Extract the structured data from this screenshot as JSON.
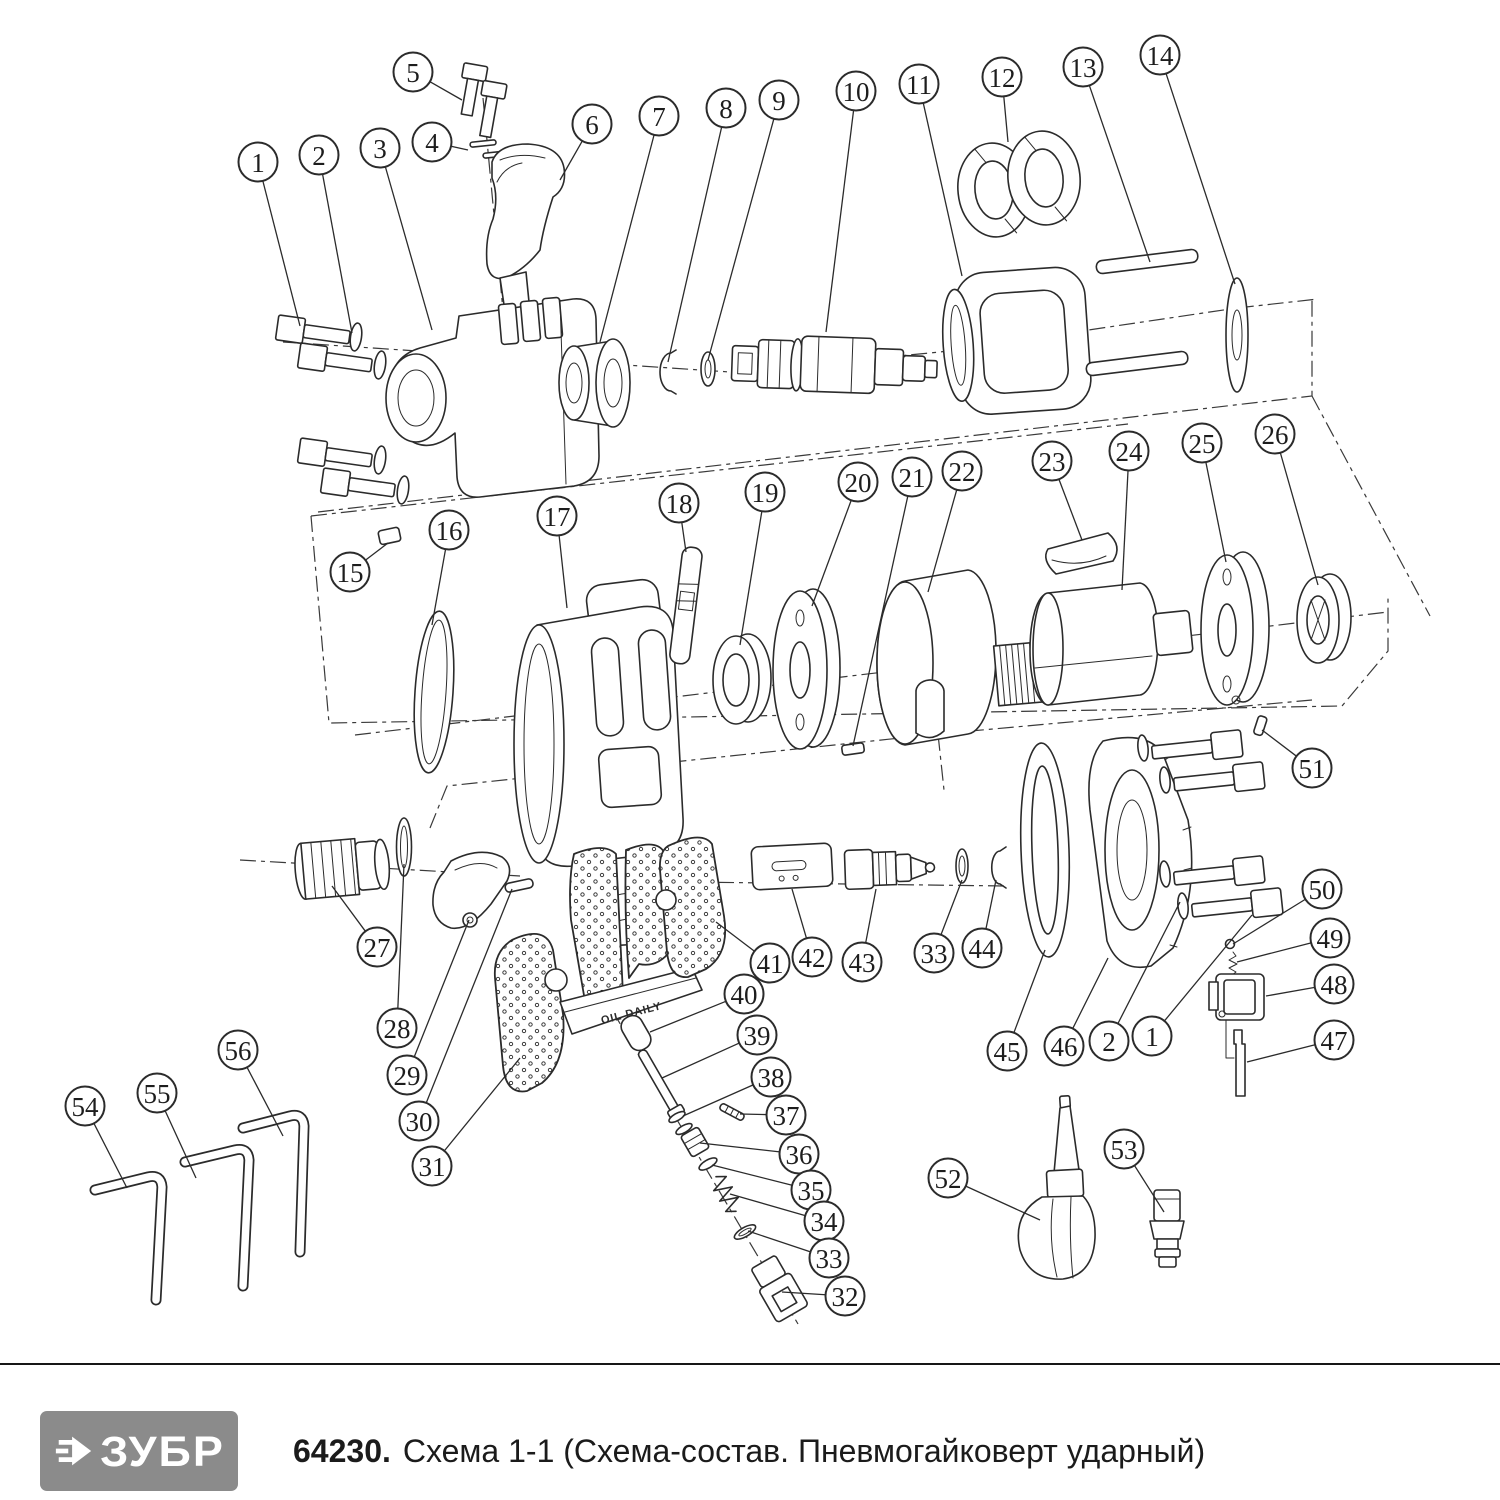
{
  "footer": {
    "brand": "ЗУБР",
    "brand_bg": "#8b8b8b",
    "code": "64230.",
    "title": "Схема 1-1 (Схема-состав. Пневмогайковерт ударный)"
  },
  "diagram": {
    "description": "Exploded parts diagram of a pneumatic impact wrench with numbered callouts",
    "embossed_text": "OIL DAILY",
    "line_color": "#2b2b2b",
    "callouts": [
      {
        "n": "1",
        "x": 258,
        "y": 162,
        "tx": 300,
        "ty": 326
      },
      {
        "n": "2",
        "x": 319,
        "y": 155,
        "tx": 352,
        "ty": 333
      },
      {
        "n": "3",
        "x": 380,
        "y": 148,
        "tx": 432,
        "ty": 330
      },
      {
        "n": "4",
        "x": 432,
        "y": 142,
        "tx": 468,
        "ty": 150
      },
      {
        "n": "5",
        "x": 413,
        "y": 72,
        "tx": 462,
        "ty": 100
      },
      {
        "n": "6",
        "x": 592,
        "y": 124,
        "tx": 560,
        "ty": 180
      },
      {
        "n": "7",
        "x": 659,
        "y": 116,
        "tx": 600,
        "ty": 342
      },
      {
        "n": "8",
        "x": 726,
        "y": 108,
        "tx": 668,
        "ty": 362
      },
      {
        "n": "9",
        "x": 779,
        "y": 100,
        "tx": 708,
        "ty": 360
      },
      {
        "n": "10",
        "x": 856,
        "y": 91,
        "tx": 826,
        "ty": 332
      },
      {
        "n": "11",
        "x": 919,
        "y": 84,
        "tx": 962,
        "ty": 276
      },
      {
        "n": "12",
        "x": 1002,
        "y": 77,
        "tx": 1008,
        "ty": 142
      },
      {
        "n": "13",
        "x": 1083,
        "y": 67,
        "tx": 1150,
        "ty": 262
      },
      {
        "n": "14",
        "x": 1160,
        "y": 55,
        "tx": 1235,
        "ty": 284
      },
      {
        "n": "15",
        "x": 350,
        "y": 572,
        "tx": 388,
        "ty": 543
      },
      {
        "n": "16",
        "x": 449,
        "y": 530,
        "tx": 432,
        "ty": 625
      },
      {
        "n": "17",
        "x": 557,
        "y": 516,
        "tx": 567,
        "ty": 608
      },
      {
        "n": "18",
        "x": 679,
        "y": 503,
        "tx": 686,
        "ty": 552
      },
      {
        "n": "19",
        "x": 765,
        "y": 492,
        "tx": 740,
        "ty": 645
      },
      {
        "n": "20",
        "x": 858,
        "y": 482,
        "tx": 812,
        "ty": 606
      },
      {
        "n": "21",
        "x": 912,
        "y": 477,
        "tx": 853,
        "ty": 746
      },
      {
        "n": "22",
        "x": 962,
        "y": 471,
        "tx": 928,
        "ty": 592
      },
      {
        "n": "23",
        "x": 1052,
        "y": 461,
        "tx": 1082,
        "ty": 540
      },
      {
        "n": "24",
        "x": 1129,
        "y": 451,
        "tx": 1122,
        "ty": 590
      },
      {
        "n": "25",
        "x": 1202,
        "y": 443,
        "tx": 1226,
        "ty": 562
      },
      {
        "n": "26",
        "x": 1275,
        "y": 434,
        "tx": 1318,
        "ty": 585
      },
      {
        "n": "51",
        "x": 1312,
        "y": 768,
        "tx": 1262,
        "ty": 730
      },
      {
        "n": "27",
        "x": 377,
        "y": 947,
        "tx": 332,
        "ty": 886
      },
      {
        "n": "28",
        "x": 397,
        "y": 1028,
        "tx": 404,
        "ty": 864
      },
      {
        "n": "29",
        "x": 407,
        "y": 1075,
        "tx": 469,
        "ty": 920
      },
      {
        "n": "30",
        "x": 419,
        "y": 1121,
        "tx": 512,
        "ty": 889
      },
      {
        "n": "31",
        "x": 432,
        "y": 1166,
        "tx": 520,
        "ty": 1058
      },
      {
        "n": "41",
        "x": 770,
        "y": 963,
        "tx": 716,
        "ty": 922
      },
      {
        "n": "42",
        "x": 812,
        "y": 957,
        "tx": 792,
        "ty": 889
      },
      {
        "n": "43",
        "x": 862,
        "y": 962,
        "tx": 876,
        "ty": 889
      },
      {
        "n": "33",
        "x": 934,
        "y": 953,
        "tx": 962,
        "ty": 880
      },
      {
        "n": "44",
        "x": 982,
        "y": 948,
        "tx": 996,
        "ty": 880
      },
      {
        "n": "45",
        "x": 1007,
        "y": 1051,
        "tx": 1045,
        "ty": 950
      },
      {
        "n": "46",
        "x": 1064,
        "y": 1046,
        "tx": 1108,
        "ty": 958
      },
      {
        "n": "2",
        "x": 1109,
        "y": 1041,
        "tx": 1180,
        "ty": 902
      },
      {
        "n": "1",
        "x": 1152,
        "y": 1036,
        "tx": 1252,
        "ty": 915
      },
      {
        "n": "50",
        "x": 1322,
        "y": 889,
        "tx": 1233,
        "ty": 944
      },
      {
        "n": "49",
        "x": 1330,
        "y": 938,
        "tx": 1237,
        "ty": 962
      },
      {
        "n": "48",
        "x": 1334,
        "y": 984,
        "tx": 1266,
        "ty": 996
      },
      {
        "n": "47",
        "x": 1334,
        "y": 1040,
        "tx": 1247,
        "ty": 1062
      },
      {
        "n": "40",
        "x": 744,
        "y": 994,
        "tx": 650,
        "ty": 1032
      },
      {
        "n": "39",
        "x": 757,
        "y": 1035,
        "tx": 662,
        "ty": 1078
      },
      {
        "n": "38",
        "x": 771,
        "y": 1077,
        "tx": 683,
        "ty": 1116
      },
      {
        "n": "37",
        "x": 786,
        "y": 1115,
        "tx": 740,
        "ty": 1114
      },
      {
        "n": "36",
        "x": 799,
        "y": 1154,
        "tx": 700,
        "ty": 1143
      },
      {
        "n": "35",
        "x": 811,
        "y": 1190,
        "tx": 712,
        "ty": 1165
      },
      {
        "n": "34",
        "x": 824,
        "y": 1221,
        "tx": 730,
        "ty": 1194
      },
      {
        "n": "33",
        "x": 829,
        "y": 1258,
        "tx": 748,
        "ty": 1231
      },
      {
        "n": "32",
        "x": 845,
        "y": 1296,
        "tx": 782,
        "ty": 1292
      },
      {
        "n": "54",
        "x": 85,
        "y": 1106,
        "tx": 127,
        "ty": 1188
      },
      {
        "n": "55",
        "x": 157,
        "y": 1093,
        "tx": 196,
        "ty": 1178
      },
      {
        "n": "56",
        "x": 238,
        "y": 1050,
        "tx": 283,
        "ty": 1136
      },
      {
        "n": "52",
        "x": 948,
        "y": 1178,
        "tx": 1040,
        "ty": 1220
      },
      {
        "n": "53",
        "x": 1124,
        "y": 1149,
        "tx": 1164,
        "ty": 1212
      }
    ]
  }
}
